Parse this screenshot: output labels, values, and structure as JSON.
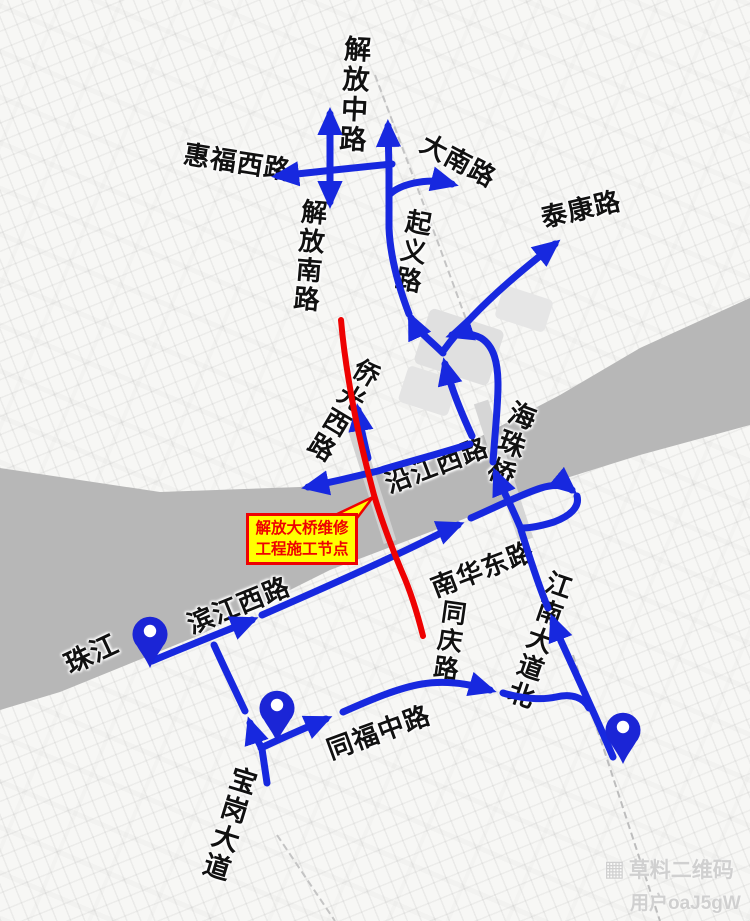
{
  "colors": {
    "route_blue": "#1728df",
    "closure_red": "#ee0202",
    "annotation_bg": "#ffff00",
    "annotation_border": "#ee0202",
    "river_gray": "#b7b7b7",
    "pin_blue": "#1b25d6",
    "label_black": "#111111"
  },
  "road_labels": {
    "jiefang_zhong": "解放中路",
    "huifu_xi": "惠福西路",
    "danan": "大南路",
    "jiefang_nan": "解放南路",
    "qiyi": "起义路",
    "taikang": "泰康路",
    "qiaoguang_xi": "侨光西路",
    "haizhu_qiao": "海珠桥",
    "yanjiang_xi": "沿江西路",
    "binjiang_xi": "滨江西路",
    "zhujiang": "珠江",
    "nanhua_dong": "南华东路",
    "tongqing": "同庆路",
    "jiangnan_dadao_bei": "江南大道北",
    "tongfu_zhong": "同福中路",
    "baogang_dadao": "宝岗大道"
  },
  "annotation": {
    "line1": "解放大桥维修",
    "line2": "工程施工节点"
  },
  "watermark": {
    "qr_glyph": "▦",
    "brand": "草料二维码",
    "user": "用户oaJ5gW"
  },
  "pins": {
    "count": 3
  }
}
